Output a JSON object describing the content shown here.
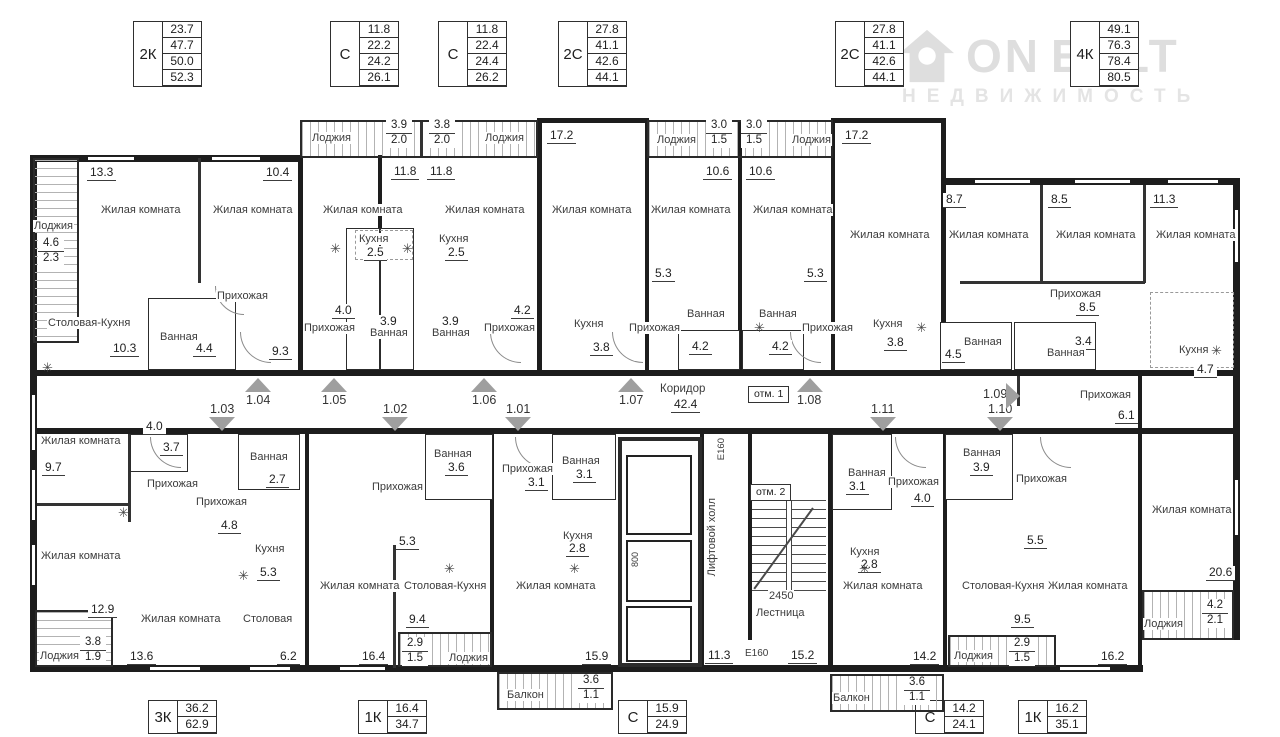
{
  "watermark": {
    "brand_left": "ON",
    "brand_right": "EALT",
    "sub": "НЕДВИЖИМОСТЬ"
  },
  "legend_top": [
    {
      "type": "2К",
      "areas": [
        "23.7",
        "47.7",
        "50.0",
        "52.3"
      ]
    },
    {
      "type": "С",
      "areas": [
        "11.8",
        "22.2",
        "24.2",
        "26.1"
      ]
    },
    {
      "type": "С",
      "areas": [
        "11.8",
        "22.4",
        "24.4",
        "26.2"
      ]
    },
    {
      "type": "2С",
      "areas": [
        "27.8",
        "41.1",
        "42.6",
        "44.1"
      ]
    },
    {
      "type": "2С",
      "areas": [
        "27.8",
        "41.1",
        "42.6",
        "44.1"
      ]
    },
    {
      "type": "4К",
      "areas": [
        "49.1",
        "76.3",
        "78.4",
        "80.5"
      ]
    }
  ],
  "legend_bottom": [
    {
      "type": "3К",
      "areas": [
        "36.2",
        "62.9"
      ]
    },
    {
      "type": "1К",
      "areas": [
        "16.4",
        "34.7"
      ]
    },
    {
      "type": "С",
      "areas": [
        "15.9",
        "24.9"
      ]
    },
    {
      "type": "С",
      "areas": [
        "14.2",
        "24.1"
      ]
    },
    {
      "type": "1К",
      "areas": [
        "16.2",
        "35.1"
      ]
    }
  ],
  "plan": {
    "corridor": {
      "name": "Коридор",
      "area": "42.4"
    },
    "marks": [
      "отм. 1",
      "отм. 2"
    ],
    "units_up": [
      "1.04",
      "1.05",
      "1.06",
      "1.07",
      "1.08"
    ],
    "units_down": [
      "1.03",
      "1.02",
      "1.01",
      "1.11",
      "1.10"
    ],
    "unit_side": "1.09",
    "core": {
      "lift_hall_name": "Лифтовой холл",
      "lift_hall_area": "11.3",
      "lift_dim": "800",
      "stairs_name": "Лестница",
      "stairs_area": "15.2",
      "stairs_dim": "2450",
      "door_hall": "E160",
      "door_stair": "E160"
    },
    "rooms": [
      {
        "n": "Лоджия",
        "a": "4.6",
        "b": "2.3"
      },
      {
        "n": "Жилая комната",
        "a": "13.3"
      },
      {
        "n": "Жилая комната",
        "a": "10.4"
      },
      {
        "n": "Прихожая"
      },
      {
        "n": "Столовая-Кухня",
        "a": "10.3"
      },
      {
        "n": "Ванная",
        "a": "4.4"
      },
      {
        "a": "9.3"
      },
      {
        "n": "Лоджия",
        "a": "3.9",
        "b": "2.0"
      },
      {
        "n": "Жилая комната",
        "a": "11.8"
      },
      {
        "n": "Кухня",
        "a": "2.5"
      },
      {
        "n": "Прихожая",
        "a": "4.0"
      },
      {
        "n": "Ванная",
        "a": "3.9"
      },
      {
        "n": "Лоджия",
        "a": "3.8",
        "b": "2.0"
      },
      {
        "n": "Жилая комната",
        "a": "11.8"
      },
      {
        "n": "Кухня",
        "a": "2.5"
      },
      {
        "n": "Прихожая",
        "a": "4.2"
      },
      {
        "n": "Ванная",
        "a": "3.9"
      },
      {
        "n": "Жилая комната",
        "a": "17.2"
      },
      {
        "n": "Кухня",
        "a": "3.8"
      },
      {
        "n": "Лоджия",
        "a": "3.0",
        "b": "1.5"
      },
      {
        "n": "Жилая комната",
        "a": "10.6"
      },
      {
        "a": "5.3"
      },
      {
        "n": "Ванная",
        "a": "4.2"
      },
      {
        "n": "Прихожая"
      },
      {
        "n": "Лоджия",
        "a": "3.0",
        "b": "1.5"
      },
      {
        "n": "Жилая комната",
        "a": "10.6"
      },
      {
        "a": "5.3"
      },
      {
        "n": "Ванная",
        "a": "4.2"
      },
      {
        "n": "Прихожая"
      },
      {
        "n": "Жилая комната",
        "a": "17.2"
      },
      {
        "n": "Кухня",
        "a": "3.8"
      },
      {
        "n": "Жилая комната",
        "a": "8.7"
      },
      {
        "n": "Жилая комната",
        "a": "8.5"
      },
      {
        "n": "Жилая комната",
        "a": "11.3"
      },
      {
        "n": "Прихожая",
        "a": "8.5"
      },
      {
        "n": "Ванная",
        "a": "4.5"
      },
      {
        "n": "Ванная",
        "a": "3.4"
      },
      {
        "n": "Кухня",
        "a": "4.7"
      },
      {
        "n": "Прихожая",
        "a": "6.1"
      },
      {
        "n": "Жилая комната",
        "a": "20.6"
      },
      {
        "n": "Лоджия",
        "a": "4.2",
        "b": "2.1"
      },
      {
        "n": "Жилая комната",
        "a": "9.7"
      },
      {
        "a": "4.0"
      },
      {
        "n": "Прихожая",
        "a": "3.7"
      },
      {
        "n": "Ванная",
        "a": "2.7"
      },
      {
        "n": "Прихожая",
        "a": "4.8"
      },
      {
        "n": "Кухня",
        "a": "5.3"
      },
      {
        "n": "Жилая комната",
        "a": "12.9"
      },
      {
        "n": "Лоджия",
        "a": "3.8",
        "b": "1.9"
      },
      {
        "n": "Жилая комната",
        "a": "13.6"
      },
      {
        "n": "Столовая",
        "a": "6.2"
      },
      {
        "n": "Жилая комната",
        "a": "16.4"
      },
      {
        "n": "Столовая-Кухня",
        "a": "9.4"
      },
      {
        "n": "Прихожая",
        "a": "5.3"
      },
      {
        "n": "Ванная",
        "a": "3.6"
      },
      {
        "n": "Лоджия",
        "a": "2.9",
        "b": "1.5"
      },
      {
        "n": "Прихожая",
        "a": "3.1"
      },
      {
        "n": "Ванная",
        "a": "3.1"
      },
      {
        "n": "Кухня",
        "a": "2.8"
      },
      {
        "n": "Жилая комната",
        "a": "15.9"
      },
      {
        "n": "Балкон",
        "a": "3.6",
        "b": "1.1"
      },
      {
        "n": "Ванная",
        "a": "3.1"
      },
      {
        "n": "Прихожая",
        "a": "4.0"
      },
      {
        "n": "Кухня",
        "a": "2.8"
      },
      {
        "n": "Жилая комната",
        "a": "14.2"
      },
      {
        "n": "Балкон",
        "a": "3.6",
        "b": "1.1"
      },
      {
        "n": "Ванная",
        "a": "3.9"
      },
      {
        "n": "Прихожая",
        "a": "5.5"
      },
      {
        "n": "Столовая-Кухня",
        "a": "9.5"
      },
      {
        "n": "Жилая комната",
        "a": "16.2"
      },
      {
        "n": "Лоджия",
        "a": "2.9",
        "b": "1.5"
      }
    ]
  }
}
